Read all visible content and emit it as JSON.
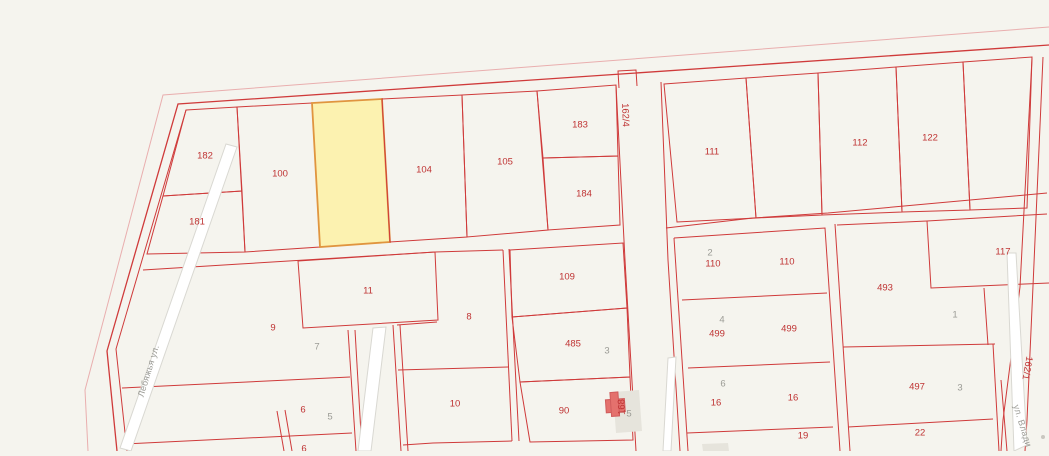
{
  "map": {
    "type": "cadastral-parcel-map",
    "background": "#f5f4ee",
    "line_red": "#cf3a3a",
    "line_light": "#e9aeae",
    "road_fill": "#ffffff",
    "road_stroke": "#d9d8d2",
    "label_red": "#bf3333",
    "label_gray": "#9b9b95",
    "selected_parcel": {
      "fill": "#fcf2b0",
      "stroke": "#e0953f"
    },
    "building_fill": "#e4716d",
    "building_stroke": "#d05c5c",
    "building_footprint": "#e6e4dc",
    "labels_red": [
      {
        "text": "182",
        "x": 205,
        "y": 156
      },
      {
        "text": "181",
        "x": 197,
        "y": 222
      },
      {
        "text": "100",
        "x": 280,
        "y": 174
      },
      {
        "text": "104",
        "x": 424,
        "y": 170
      },
      {
        "text": "105",
        "x": 505,
        "y": 162
      },
      {
        "text": "183",
        "x": 580,
        "y": 125
      },
      {
        "text": "184",
        "x": 584,
        "y": 194
      },
      {
        "text": "111",
        "x": 712,
        "y": 152
      },
      {
        "text": "112",
        "x": 860,
        "y": 143
      },
      {
        "text": "122",
        "x": 930,
        "y": 138
      },
      {
        "text": "117",
        "x": 1003,
        "y": 252
      },
      {
        "text": "109",
        "x": 567,
        "y": 277
      },
      {
        "text": "485",
        "x": 573,
        "y": 344
      },
      {
        "text": "90",
        "x": 564,
        "y": 411
      },
      {
        "text": "9",
        "x": 273,
        "y": 328
      },
      {
        "text": "11",
        "x": 368,
        "y": 291
      },
      {
        "text": "8",
        "x": 469,
        "y": 317
      },
      {
        "text": "10",
        "x": 455,
        "y": 404
      },
      {
        "text": "6",
        "x": 303,
        "y": 410
      },
      {
        "text": "6",
        "x": 304,
        "y": 449
      },
      {
        "text": "110",
        "x": 713,
        "y": 264
      },
      {
        "text": "110",
        "x": 787,
        "y": 262
      },
      {
        "text": "499",
        "x": 717,
        "y": 334
      },
      {
        "text": "499",
        "x": 789,
        "y": 329
      },
      {
        "text": "16",
        "x": 716,
        "y": 403
      },
      {
        "text": "16",
        "x": 793,
        "y": 398
      },
      {
        "text": "19",
        "x": 803,
        "y": 436
      },
      {
        "text": "493",
        "x": 885,
        "y": 288
      },
      {
        "text": "497",
        "x": 917,
        "y": 387
      },
      {
        "text": "22",
        "x": 920,
        "y": 433
      }
    ],
    "labels_gray": [
      {
        "text": "7",
        "x": 317,
        "y": 347
      },
      {
        "text": "5",
        "x": 330,
        "y": 417
      },
      {
        "text": "3",
        "x": 607,
        "y": 351
      },
      {
        "text": "5",
        "x": 629,
        "y": 414
      },
      {
        "text": "2",
        "x": 710,
        "y": 253
      },
      {
        "text": "4",
        "x": 722,
        "y": 320
      },
      {
        "text": "6",
        "x": 723,
        "y": 384
      },
      {
        "text": "1",
        "x": 955,
        "y": 315
      },
      {
        "text": "3",
        "x": 960,
        "y": 388
      }
    ],
    "labels_red_rotated": [
      {
        "text": "162/4",
        "x": 625,
        "y": 115,
        "rot": 88
      },
      {
        "text": "162/1",
        "x": 1027,
        "y": 368,
        "rot": 100
      },
      {
        "text": "168",
        "x": 622,
        "y": 407,
        "rot": -92
      }
    ],
    "labels_streets": [
      {
        "text": "Лебяжья ул.",
        "x": 149,
        "y": 371,
        "rot": -73
      },
      {
        "text": "ул. Влади",
        "x": 1022,
        "y": 426,
        "rot": 73
      }
    ]
  }
}
